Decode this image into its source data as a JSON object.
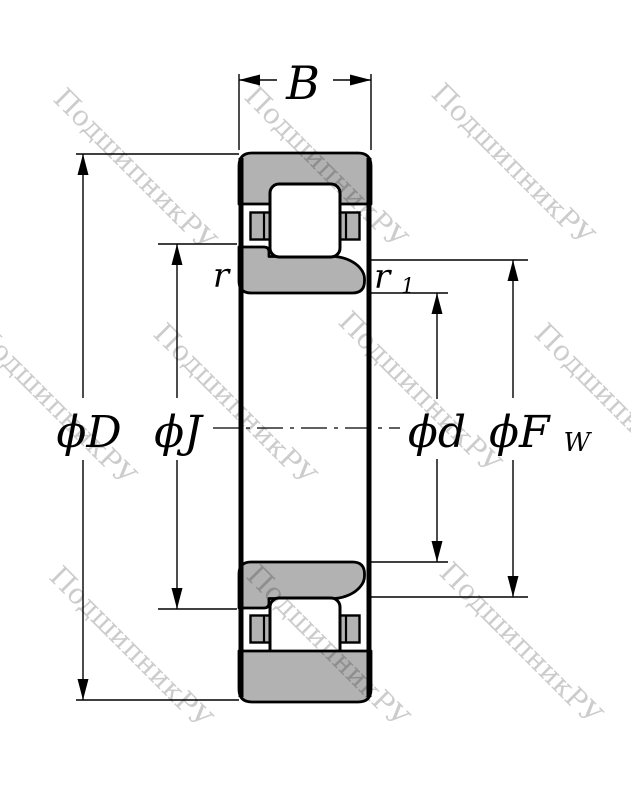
{
  "diagram": {
    "type": "bearing-cross-section-drawing",
    "watermark": {
      "text": "ПодшипникРУ"
    },
    "labels": {
      "width": "B",
      "outer_diameter": "ϕD",
      "flange_diameter": "ϕJ",
      "bore_diameter": "ϕd",
      "raceway_diameter_main": "ϕF",
      "raceway_diameter_sub": "W",
      "outer_chamfer": "r",
      "inner_chamfer_main": "r",
      "inner_chamfer_sub": "1"
    },
    "colors": {
      "ring_fill": "#b2b2b2",
      "line": "#000000",
      "watermark": "rgba(0,0,0,0.2)",
      "background": "#ffffff"
    }
  }
}
